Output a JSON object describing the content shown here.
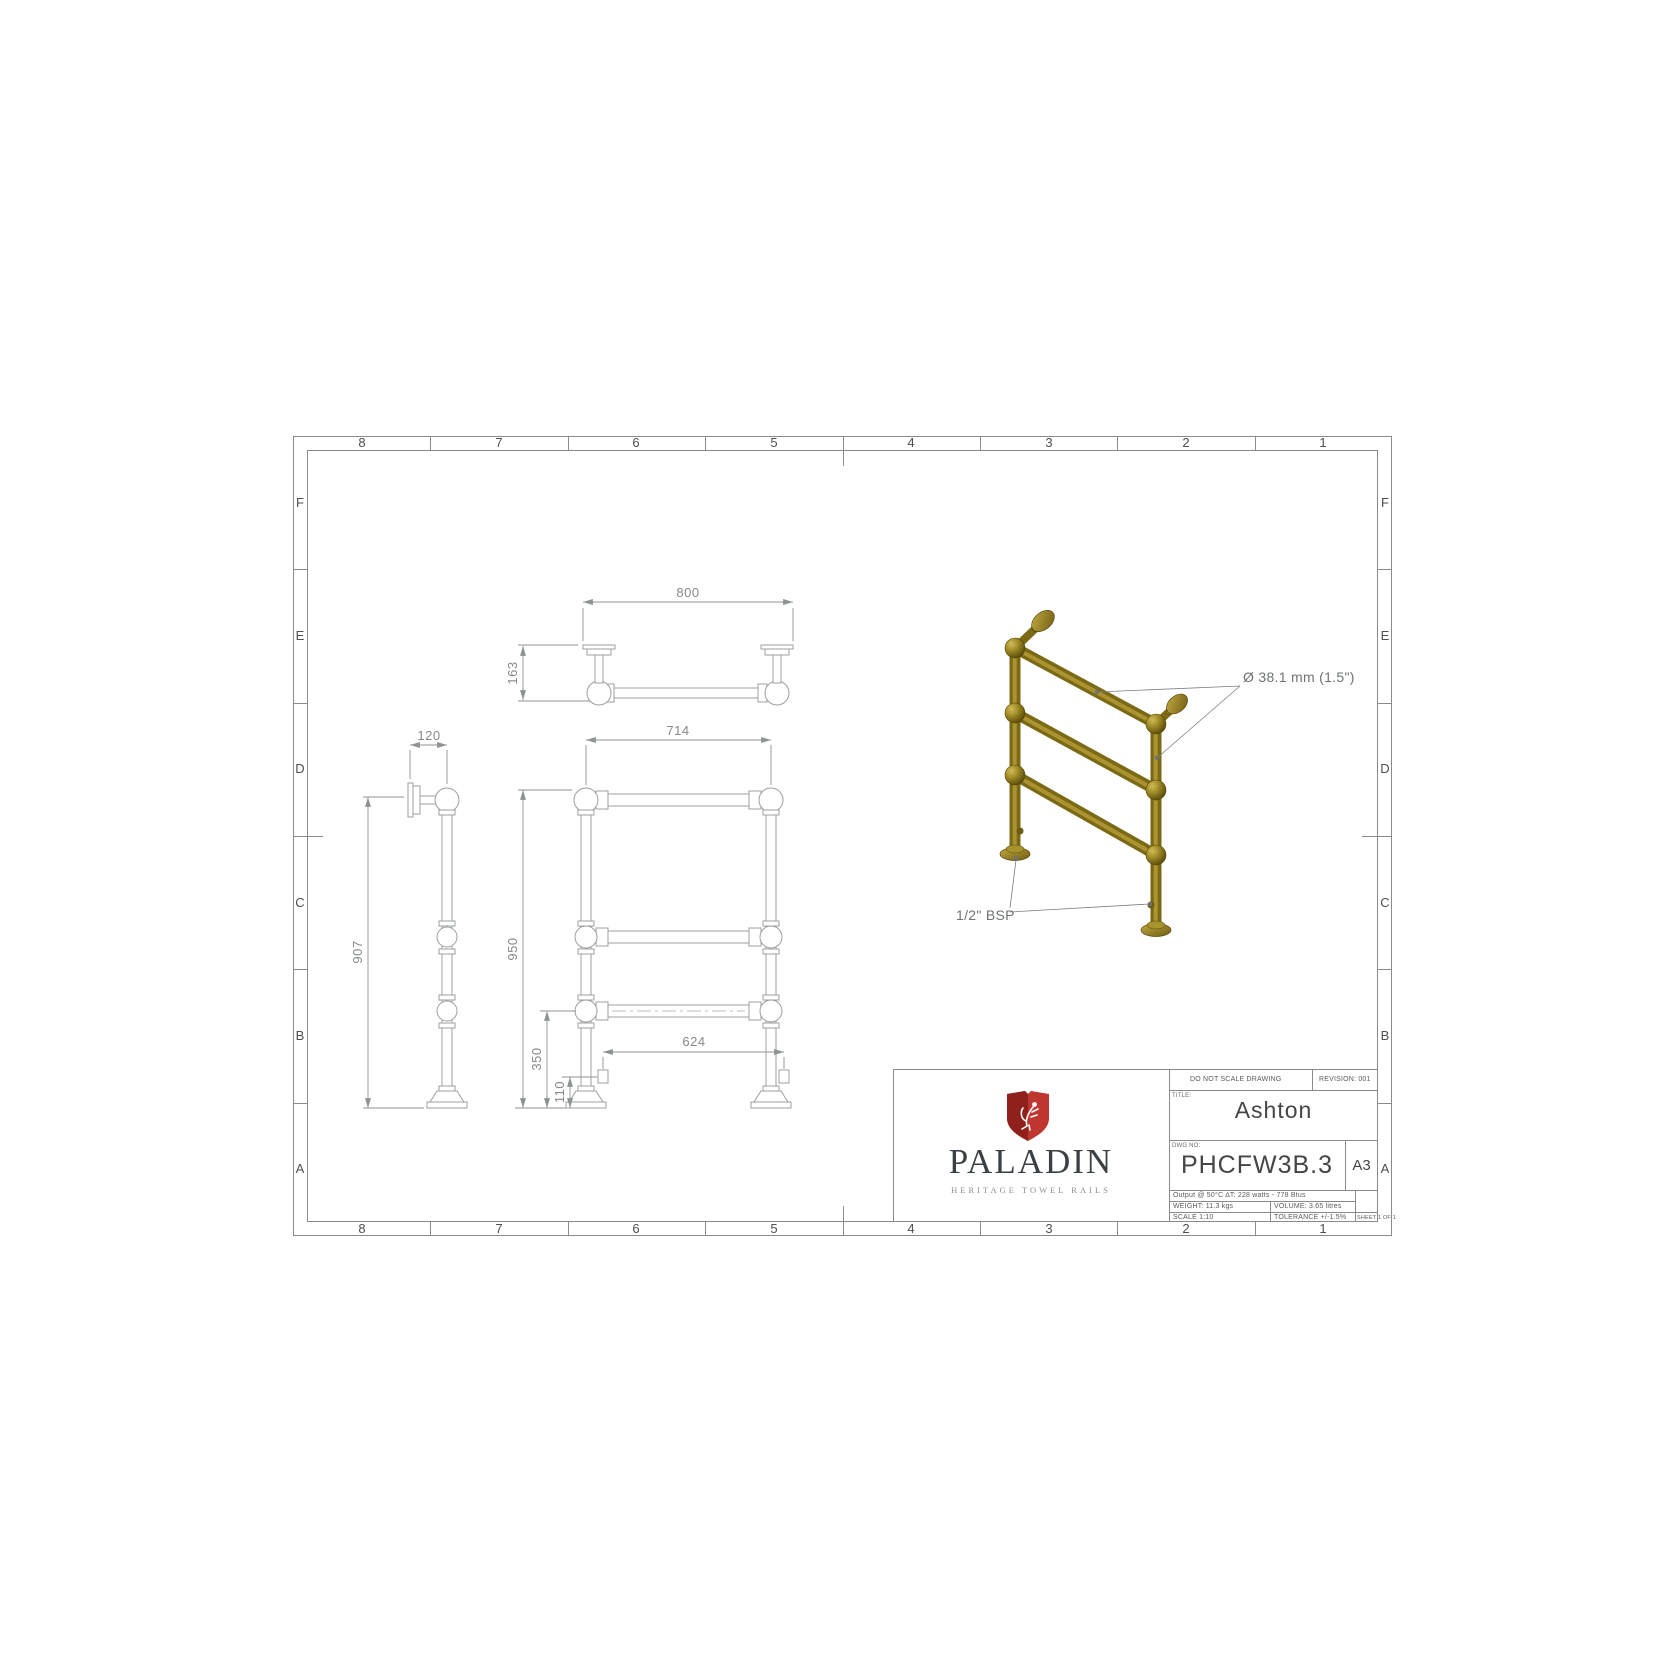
{
  "sheet": {
    "grid_cols": [
      "8",
      "7",
      "6",
      "5",
      "4",
      "3",
      "2",
      "1"
    ],
    "grid_rows": [
      "F",
      "E",
      "D",
      "C",
      "B",
      "A"
    ]
  },
  "dimensions": {
    "overall_width": "800",
    "wall_depth": "163",
    "side_width": "120",
    "rail_centres": "714",
    "side_height": "907",
    "overall_height": "950",
    "bottom_rail_height": "350",
    "element_height": "110",
    "element_centres": "624"
  },
  "annotations": {
    "tube_diameter": "Ø 38.1 mm (1.5\")",
    "connection": "1/2\" BSP"
  },
  "title_block": {
    "do_not_scale": "DO NOT SCALE DRAWING",
    "revision": "REVISION: 001",
    "title_label": "TITLE:",
    "title": "Ashton",
    "dwg_label": "DWG NO:",
    "dwg_no": "PHCFW3B.3",
    "paper_size": "A3",
    "output": "Output @ 50°C ∆T: 228 watts - 778 Btus",
    "weight": "WEIGHT: 11.3 kgs",
    "volume": "VOLUME: 3.65 litres",
    "scale": "SCALE 1:10",
    "tolerance": "TOLERANCE +/-1.5%",
    "sheet": "SHEET 1 OF 1"
  },
  "logo": {
    "brand": "PALADIN",
    "tagline": "HERITAGE TOWEL RAILS"
  },
  "colors": {
    "accent_red": "#bf3630",
    "accent_red_dark": "#8f201c",
    "gold": "#8e7b1f"
  }
}
